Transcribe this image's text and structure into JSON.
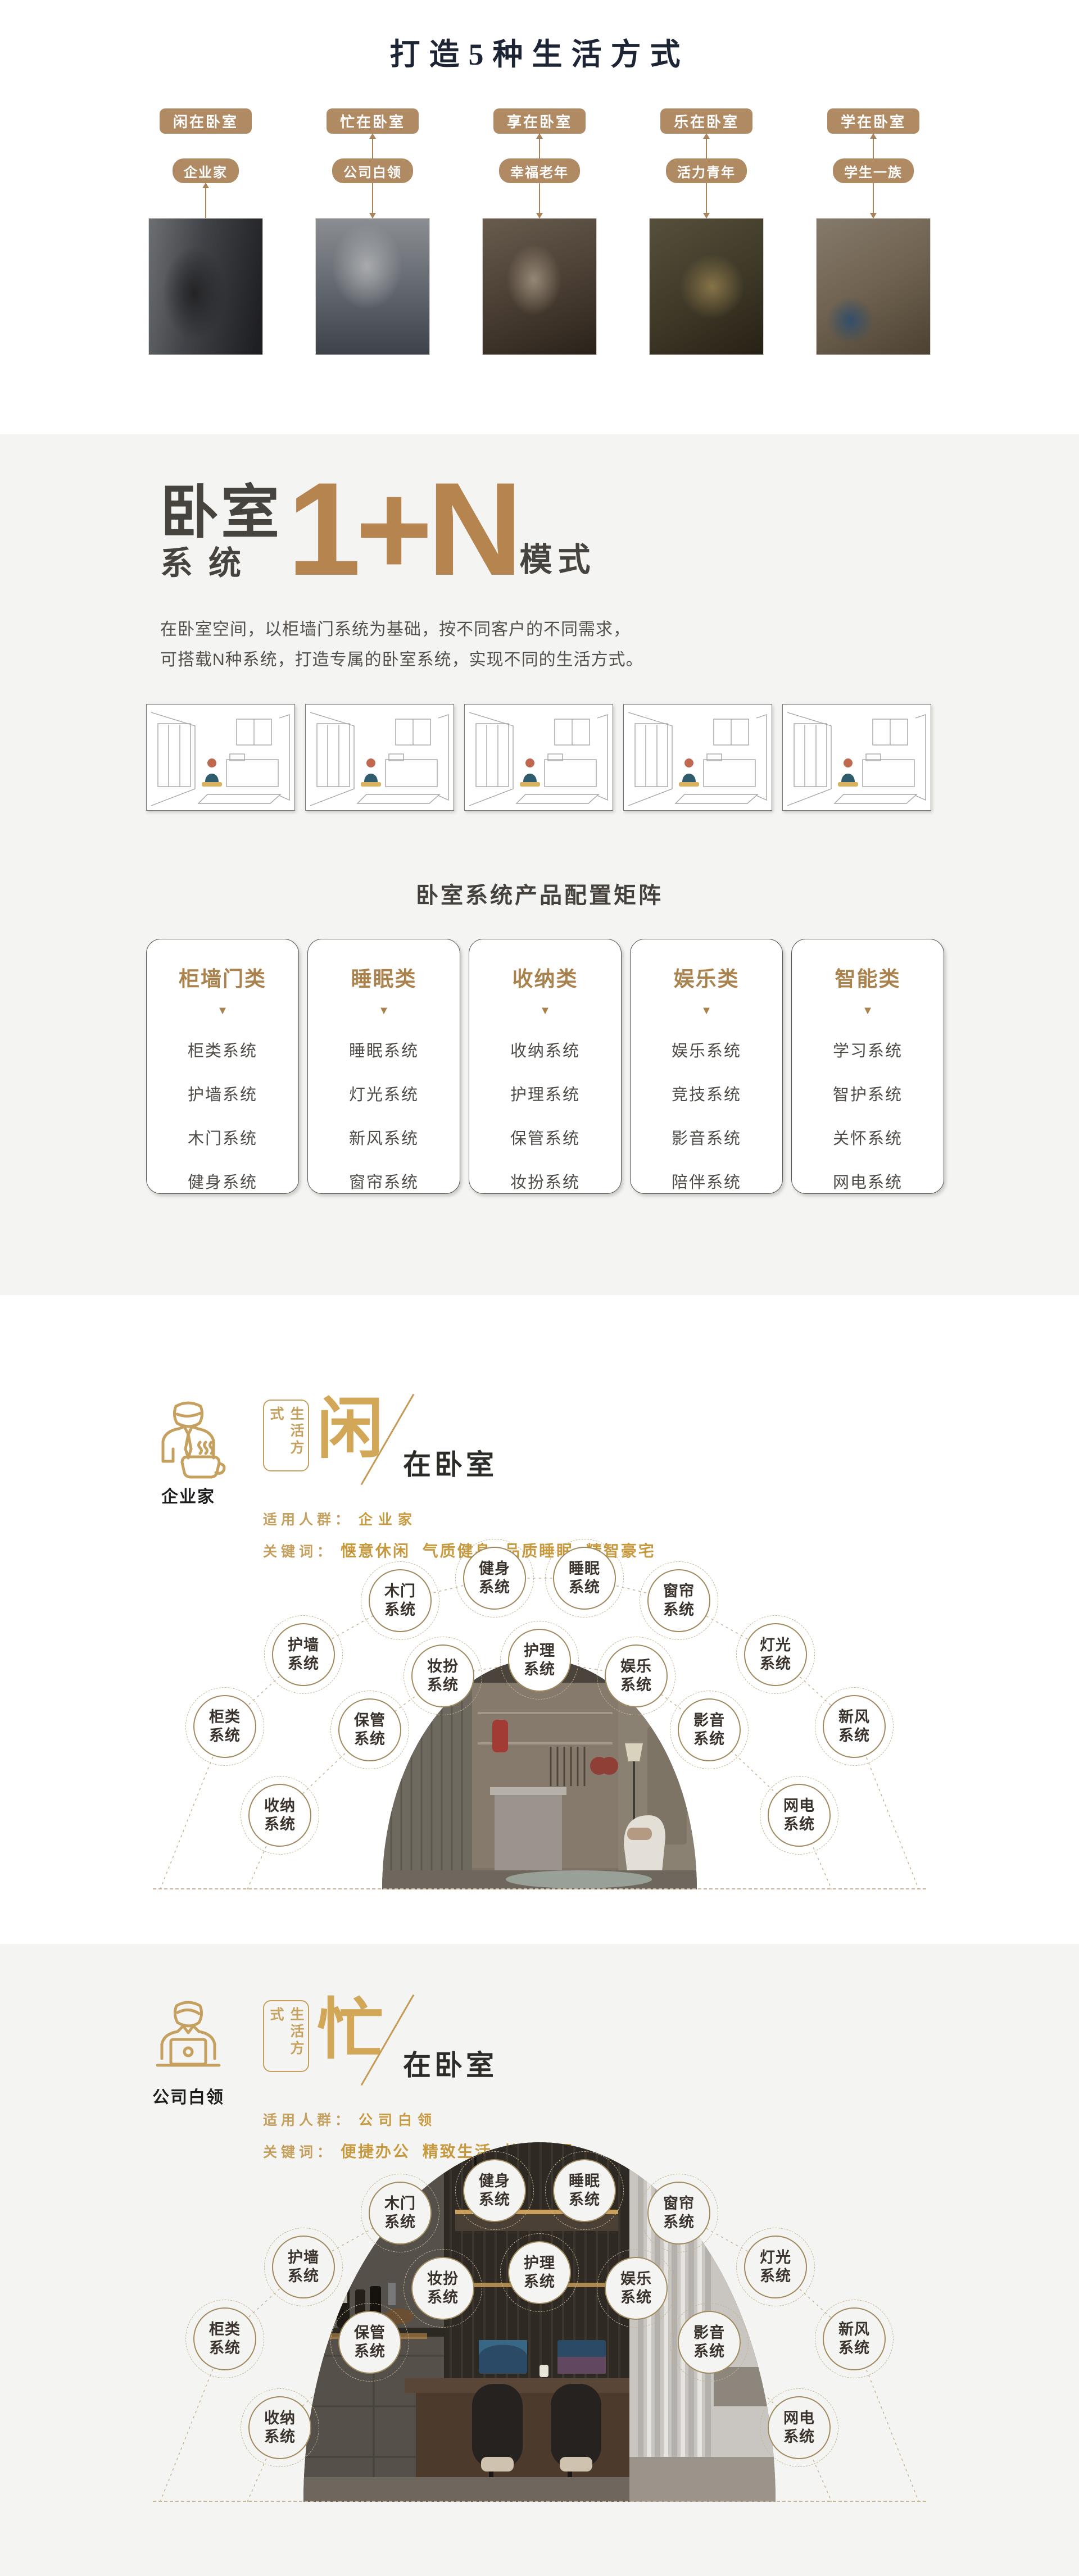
{
  "colors": {
    "accent_tan": "#b08a63",
    "accent_bronze": "#b5844f",
    "accent_gold": "#c5a05f",
    "keyword_gold": "#c89a3f",
    "dark_text": "#45413d",
    "section_gray": "#f4f4f2"
  },
  "hero": {
    "title": "打造5种生活方式",
    "columns": [
      {
        "tag": "闲在卧室",
        "person": "企业家",
        "photo": "businessman-phone-photo"
      },
      {
        "tag": "忙在卧室",
        "person": "公司白领",
        "photo": "office-lady-laptop-photo"
      },
      {
        "tag": "享在卧室",
        "person": "幸福老年",
        "photo": "happy-seniors-photo"
      },
      {
        "tag": "乐在卧室",
        "person": "活力青年",
        "photo": "young-friends-photo"
      },
      {
        "tag": "学在卧室",
        "person": "学生一族",
        "photo": "student-study-photo"
      }
    ]
  },
  "mode": {
    "word1": "卧室",
    "word2": "系统",
    "formula": "1+N",
    "word3": "模式",
    "desc_line1": "在卧室空间，以柜墙门系统为基础，按不同客户的不同需求，",
    "desc_line2": "可搭载N种系统，打造专属的卧室系统，实现不同的生活方式。",
    "illustrations": [
      "leisure-room-sketch",
      "work-room-sketch",
      "enjoy-room-sketch",
      "fun-room-sketch",
      "study-room-sketch"
    ]
  },
  "matrix": {
    "title": "卧室系统产品配置矩阵",
    "triangle": "▼",
    "cards": [
      {
        "title": "柜墙门类",
        "items": [
          "柜类系统",
          "护墙系统",
          "木门系统",
          "健身系统"
        ]
      },
      {
        "title": "睡眠类",
        "items": [
          "睡眠系统",
          "灯光系统",
          "新风系统",
          "窗帘系统"
        ]
      },
      {
        "title": "收纳类",
        "items": [
          "收纳系统",
          "护理系统",
          "保管系统",
          "妆扮系统"
        ]
      },
      {
        "title": "娱乐类",
        "items": [
          "娱乐系统",
          "竞技系统",
          "影音系统",
          "陪伴系统"
        ]
      },
      {
        "title": "智能类",
        "items": [
          "学习系统",
          "智护系统",
          "关怀系统",
          "网电系统"
        ]
      }
    ]
  },
  "lifestyles": {
    "xian": {
      "box": "生活方式",
      "big": "闲",
      "rest": "在卧室",
      "persona": "企业家",
      "audience_label": "适用人群：",
      "audience": "企业家",
      "keywords_label": "关键词：",
      "keywords": "惬意休闲  气质健身  品质睡眠  精智豪宅"
    },
    "mang": {
      "box": "生活方式",
      "big": "忙",
      "rest": "在卧室",
      "persona": "公司白领",
      "audience_label": "适用人群：",
      "audience": "公司白领",
      "keywords_label": "关键词：",
      "keywords": "便捷办公  精致生活  忙里偷闲"
    }
  },
  "fan_circles": [
    {
      "top": "柜类",
      "bottom": "系统"
    },
    {
      "top": "护墙",
      "bottom": "系统"
    },
    {
      "top": "木门",
      "bottom": "系统"
    },
    {
      "top": "健身",
      "bottom": "系统"
    },
    {
      "top": "睡眠",
      "bottom": "系统"
    },
    {
      "top": "窗帘",
      "bottom": "系统"
    },
    {
      "top": "灯光",
      "bottom": "系统"
    },
    {
      "top": "新风",
      "bottom": "系统"
    },
    {
      "top": "收纳",
      "bottom": "系统"
    },
    {
      "top": "保管",
      "bottom": "系统"
    },
    {
      "top": "妆扮",
      "bottom": "系统"
    },
    {
      "top": "护理",
      "bottom": "系统"
    },
    {
      "top": "娱乐",
      "bottom": "系统"
    },
    {
      "top": "影音",
      "bottom": "系统"
    },
    {
      "top": "网电",
      "bottom": "系统"
    }
  ]
}
